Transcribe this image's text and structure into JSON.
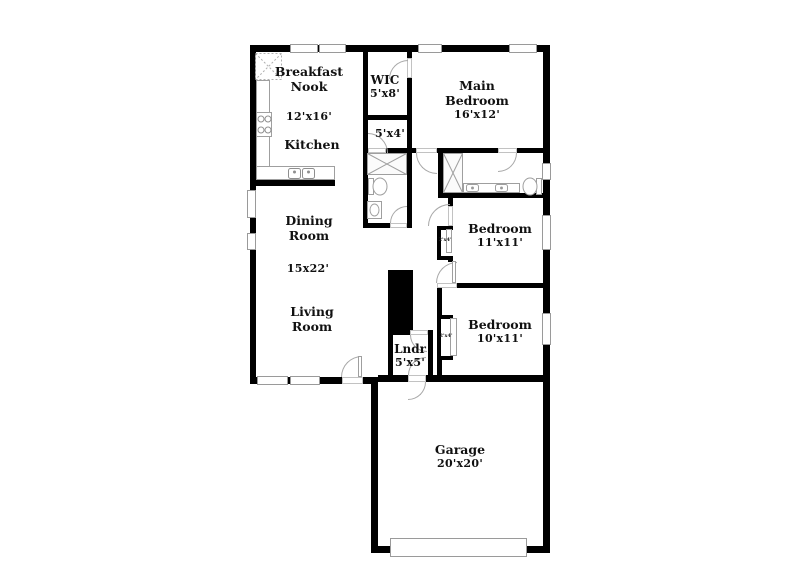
{
  "colors": {
    "wall": "#000000",
    "window_border": "#9a9a9a",
    "fixture_line": "#9f9f9f",
    "text": "#111111",
    "background": "#ffffff"
  },
  "rooms": {
    "breakfast_nook": {
      "line1": "Breakfast",
      "line2": "Nook",
      "dim": "12'x16'"
    },
    "kitchen": {
      "label": "Kitchen"
    },
    "wic": {
      "label": "WIC",
      "dim": "5'x8'"
    },
    "hall_closet": {
      "dim": "5'x4'"
    },
    "main_bedroom": {
      "line1": "Main",
      "line2": "Bedroom",
      "dim": "16'x12'"
    },
    "bedroom_mid": {
      "label": "Bedroom",
      "dim": "11'x11'"
    },
    "bedroom_back": {
      "label": "Bedroom",
      "dim": "10'x11'"
    },
    "dining_room": {
      "line1": "Dining",
      "line2": "Room"
    },
    "great_room": {
      "dim": "15x22'"
    },
    "living_room": {
      "line1": "Living",
      "line2": "Room"
    },
    "laundry": {
      "label": "Lndr",
      "dim": "5'x5'"
    },
    "garage": {
      "label": "Garage",
      "dim": "20'x20'"
    },
    "closet_mid_bedroom": {
      "dim": "2'x4'"
    },
    "closet_back_bedroom": {
      "dim": "2'x4'"
    }
  }
}
